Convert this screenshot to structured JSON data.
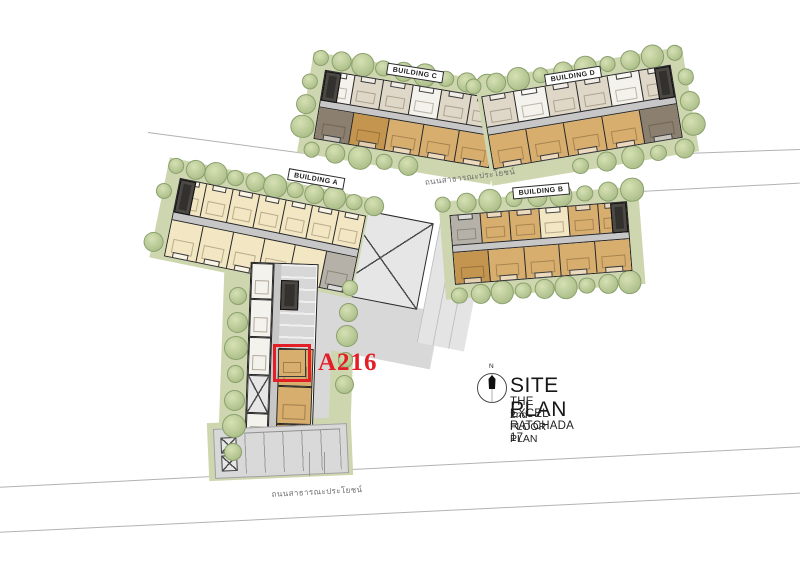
{
  "palette": {
    "background": "#ffffff",
    "outline": "#1e1e1e",
    "corridor": "#c7c7c7",
    "paving": "#d8d8d8",
    "landscape": "#cdd6ae",
    "tree_fill": "#b5c692",
    "tree_edge": "#8aa06c",
    "road_line": "#b2b2b2",
    "highlight_red": "#e31e26",
    "units": {
      "cream": "#f2e6c3",
      "tan": "#d7ae6e",
      "brown": "#c3954f",
      "taupe": "#8b8070",
      "white": "#f4f2ec",
      "beige": "#dfd8c8",
      "gray": "#b5b1a8",
      "dark": "#33312d"
    }
  },
  "plan": {
    "buildings": [
      {
        "id": "building-a",
        "label": "BUILDING A",
        "rows": [
          [
            "cream",
            "cream",
            "cream",
            "cream",
            "cream",
            "cream",
            "cream"
          ],
          [
            "cream",
            "cream",
            "cream",
            "cream",
            "cream",
            "gray"
          ]
        ]
      },
      {
        "id": "building-b",
        "label": "BUILDING B",
        "rows": [
          [
            "gray",
            "tan",
            "tan",
            "cream",
            "tan",
            "tan"
          ],
          [
            "brown",
            "tan",
            "tan",
            "tan",
            "tan"
          ]
        ]
      },
      {
        "id": "building-c",
        "label": "BUILDING C",
        "rows": [
          [
            "white",
            "beige",
            "beige",
            "white",
            "beige",
            "beige"
          ],
          [
            "taupe",
            "brown",
            "tan",
            "tan",
            "tan"
          ]
        ]
      },
      {
        "id": "building-d",
        "label": "BUILDING D",
        "rows": [
          [
            "beige",
            "white",
            "beige",
            "beige",
            "white",
            "beige"
          ],
          [
            "tan",
            "tan",
            "tan",
            "tan",
            "taupe"
          ]
        ]
      }
    ],
    "wing": {
      "left_units": [
        "white",
        "white",
        "white",
        "stair",
        "white",
        "gray"
      ],
      "right_units": [
        "parking",
        "a216",
        "tan",
        "brown",
        "gray"
      ]
    },
    "roads": [
      {
        "id": "road-north",
        "label": "ถนนสาธารณะประโยชน์"
      },
      {
        "id": "road-south",
        "label": "ถนนสาธารณะประโยชน์"
      }
    ],
    "highlight_unit": {
      "label": "A216"
    }
  },
  "legend": {
    "compass_n": "N",
    "title": "SITE PLAN",
    "project": "THE EXCEL RATCHADA 17",
    "subtitle": "2nd FLOOR PLAN"
  }
}
